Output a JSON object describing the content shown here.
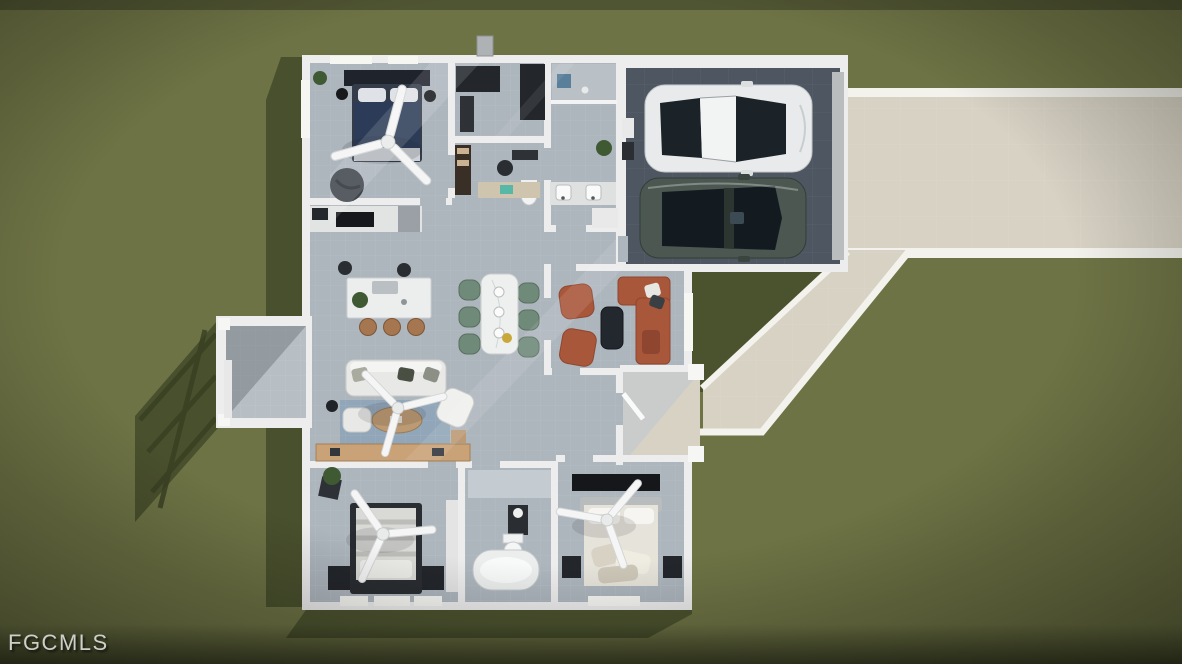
{
  "watermark": {
    "text": "FGCMLS"
  },
  "scene": {
    "type": "3d-aerial-floorplan-render",
    "elements": [
      "lawn",
      "house-shell",
      "master-bedroom",
      "walk-in-closet",
      "master-bathroom",
      "study-nook",
      "kitchen",
      "dining-area",
      "family-room",
      "living-room",
      "bedroom-2",
      "bathroom-2",
      "bedroom-3",
      "entry-porch",
      "lanai",
      "garage",
      "white-sedan",
      "dark-sedan",
      "driveway",
      "walkway",
      "ceiling-fan",
      "fgcmls-watermark"
    ]
  },
  "colors": {
    "grass": "#6e7345",
    "grassShadow": "#454c2a",
    "grassShadowDark": "#383f22",
    "floor": "#adb5bd",
    "floorLight": "#c4cbd1",
    "wall": "#ededee",
    "garageFloor": "#4e5761",
    "driveway": "#d7d2c4",
    "curb": "#f3f2ec",
    "carWhite": "#e8eaeb",
    "carDark": "#4b5750",
    "glass": "#1b2328",
    "bedNavy": "#2c3c58",
    "darkFurniture": "#23262b",
    "rust": "#a9573a",
    "rustDark": "#8f4630",
    "chairGreen": "#6f8a79",
    "wood": "#bc9a74",
    "stool": "#a5764f",
    "rug": "#91a6b8",
    "sofaWhite": "#e8e8e6",
    "plant": "#3f5a33",
    "teal": "#58b8a8",
    "blueMat": "#5a7f9a",
    "watermark": "#cfcfc9"
  }
}
